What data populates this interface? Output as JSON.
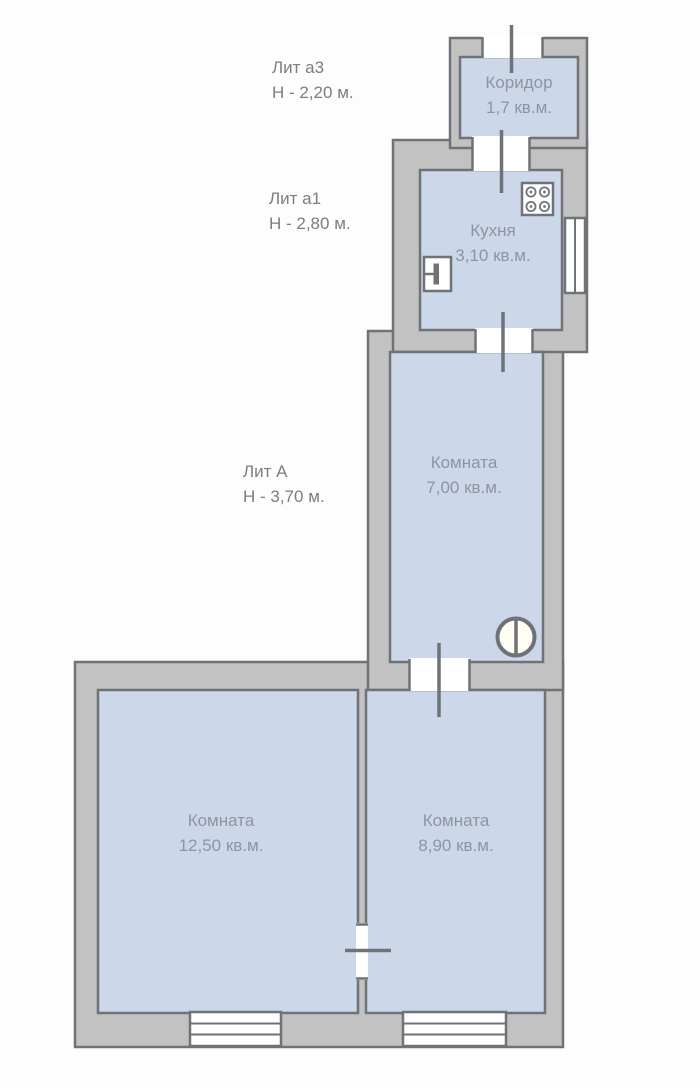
{
  "plan": {
    "colors": {
      "bg": "#fdfdfd",
      "wall_fill": "#c2c2c2",
      "wall_line": "#6f7276",
      "room_fill": "#ccd7e9",
      "annotation_text": "#7d7d7d",
      "room_text": "#8e95a2",
      "opening_fill": "#ffffff",
      "basin_fill": "#fffdf4"
    },
    "annotations": [
      {
        "id": "lit-a3",
        "line1": "Лит а3",
        "line2": "Н - 2,20 м."
      },
      {
        "id": "lit-a1",
        "line1": "Лит а1",
        "line2": "Н - 2,80 м."
      },
      {
        "id": "lit-A",
        "line1": "Лит А",
        "line2": "Н - 3,70 м."
      }
    ],
    "rooms": [
      {
        "id": "koridor",
        "name": "Коридор",
        "area": "1,7 кв.м."
      },
      {
        "id": "kitchen",
        "name": "Кухня",
        "area": "3,10 кв.м."
      },
      {
        "id": "room-7",
        "name": "Комната",
        "area": "7,00 кв.м."
      },
      {
        "id": "room-12-5",
        "name": "Комната",
        "area": "12,50 кв.м."
      },
      {
        "id": "room-8-9",
        "name": "Комната",
        "area": "8,90 кв.м."
      }
    ],
    "icons": {
      "stove": "stove-icon",
      "kitchen_sink": "sink-icon",
      "washbasin": "washbasin-icon",
      "door": "door-opening",
      "window": "window-symbol"
    }
  }
}
